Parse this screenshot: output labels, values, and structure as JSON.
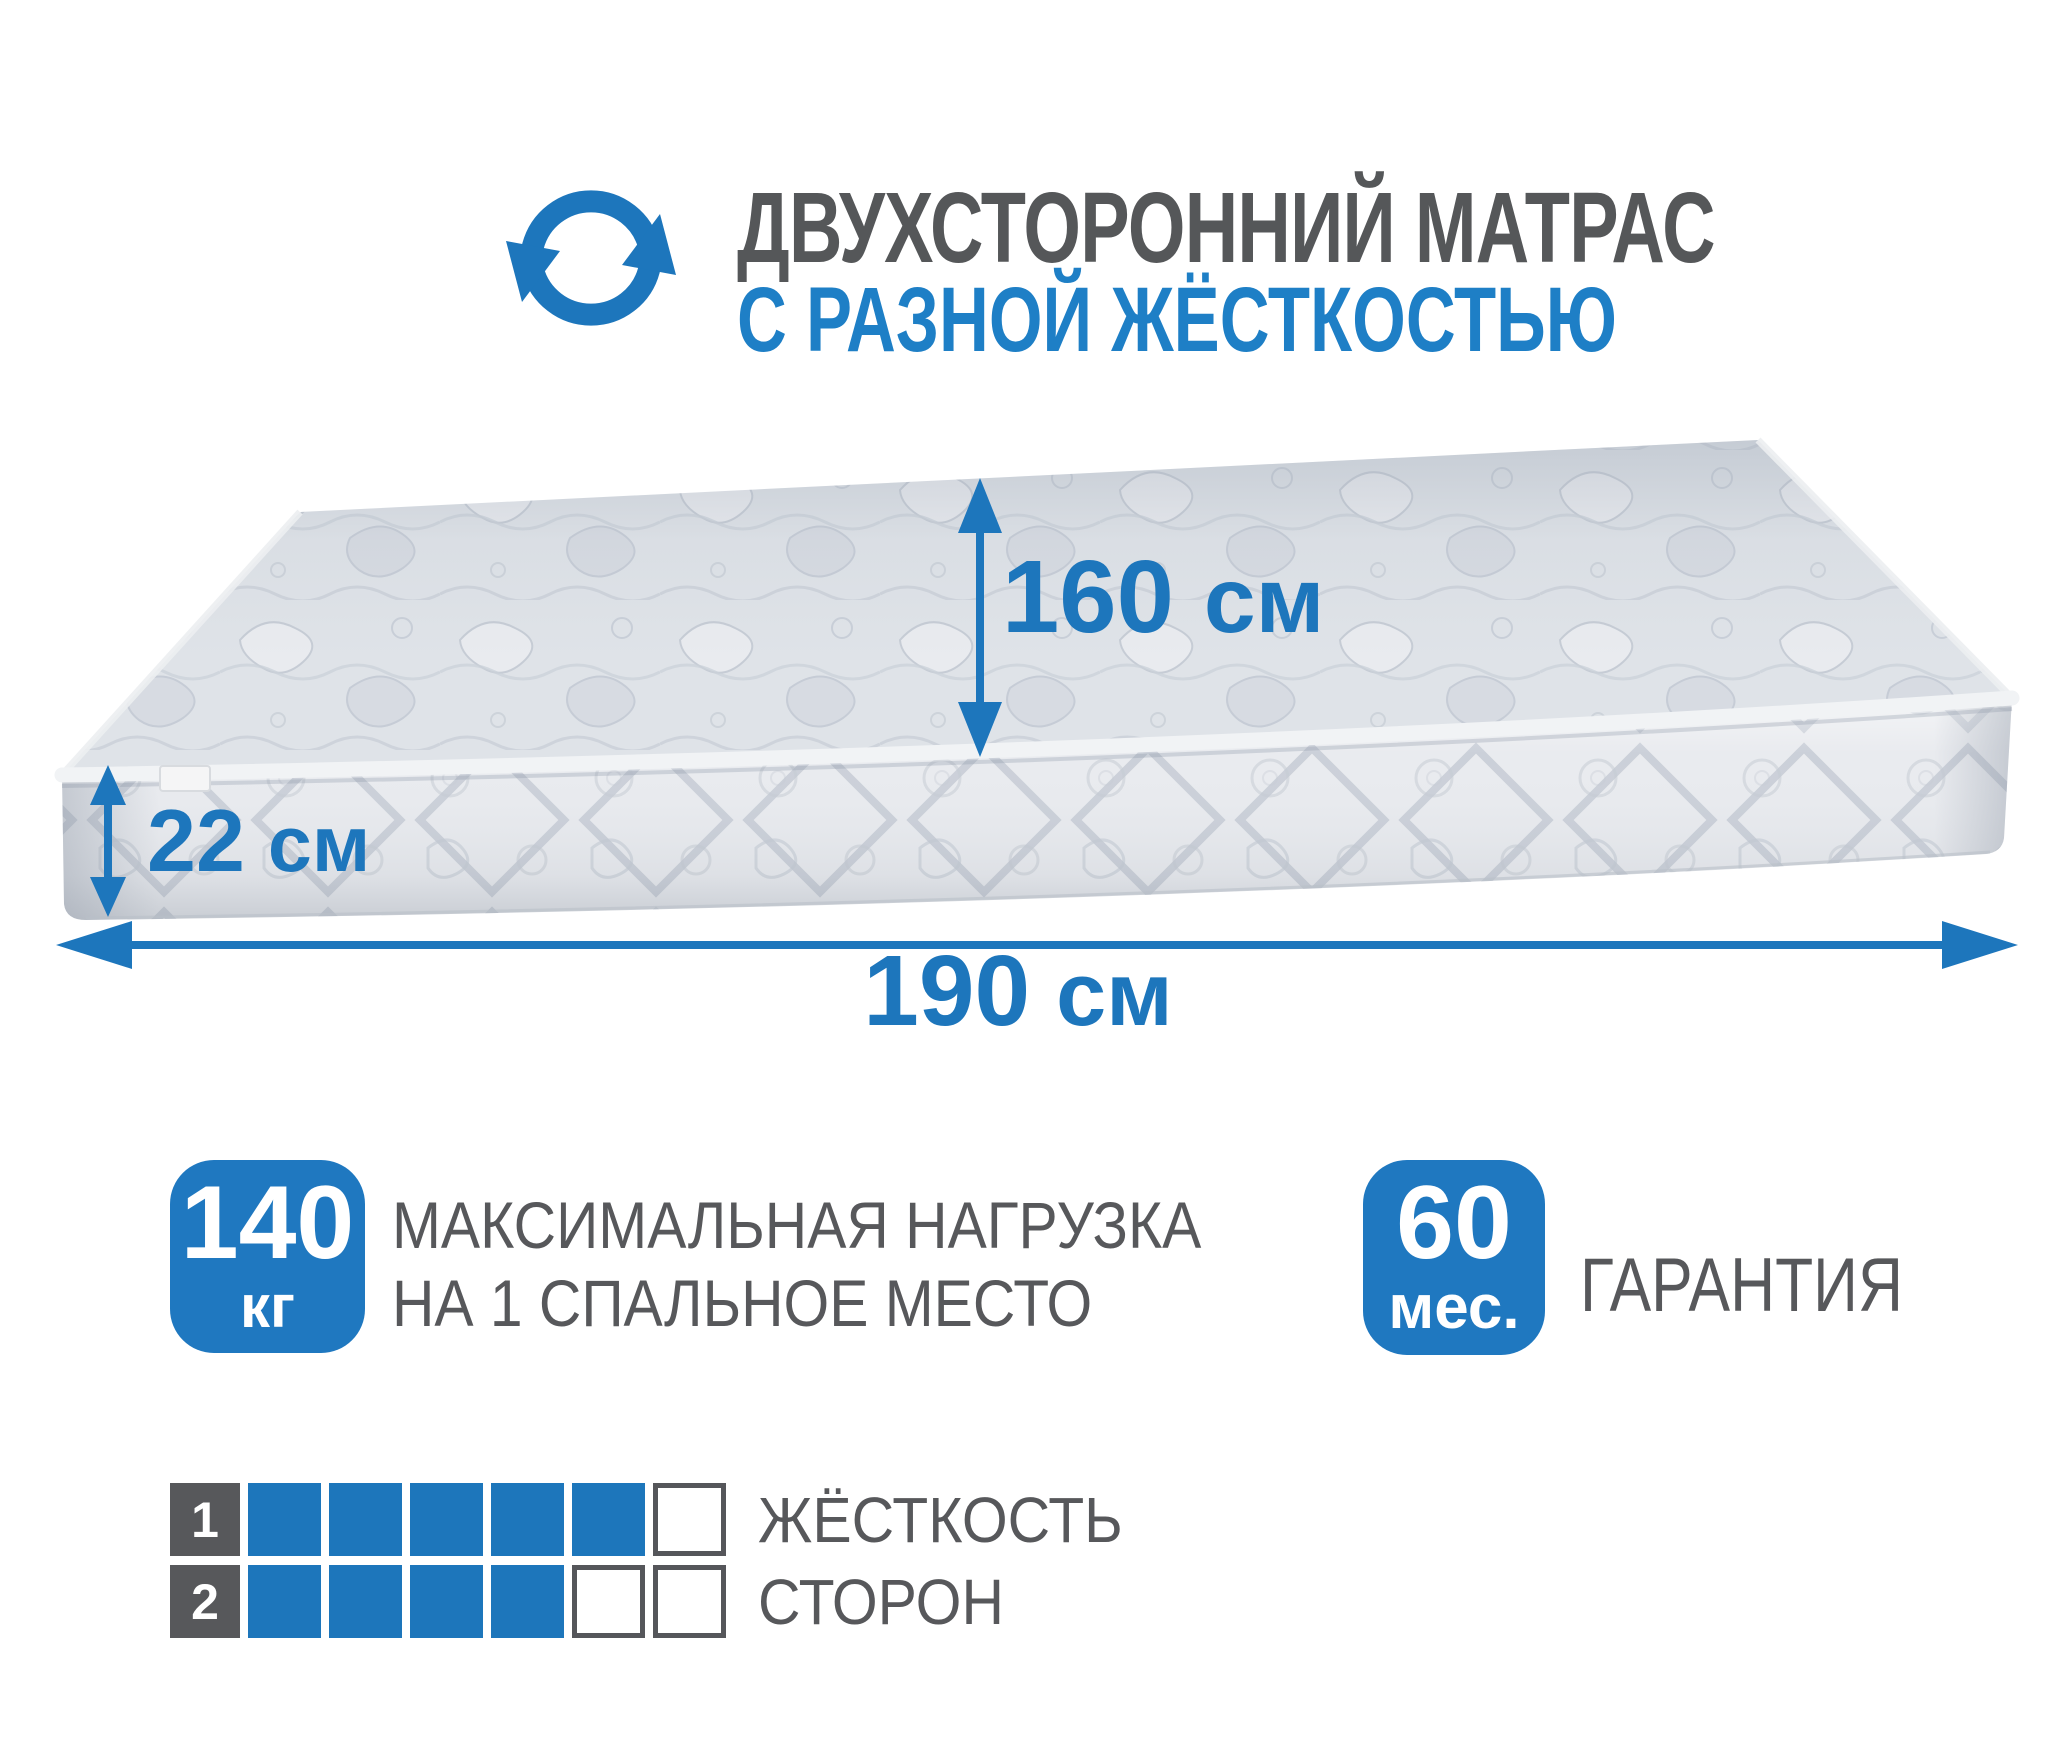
{
  "colors": {
    "accent": "#1d76bc",
    "gray_text": "#57585b"
  },
  "header": {
    "icon": "rotate-arrows-icon",
    "title": "ДВУХСТОРОННИЙ МАТРАС",
    "subtitle": "С РАЗНОЙ ЖЁСТКОСТЬЮ"
  },
  "dimensions": {
    "depth": {
      "value": "160",
      "unit": "см"
    },
    "height": {
      "value": "22",
      "unit": "см"
    },
    "length": {
      "value": "190",
      "unit": "см"
    }
  },
  "badges": {
    "max_load": {
      "value": "140",
      "unit": "кг",
      "label_line1": "МАКСИМАЛЬНАЯ НАГРУЗКА",
      "label_line2": "НА 1 СПАЛЬНОЕ МЕСТО"
    },
    "warranty": {
      "value": "60",
      "unit": "мес.",
      "label": "ГАРАНТИЯ"
    }
  },
  "firmness": {
    "label_line1": "ЖЁСТКОСТЬ",
    "label_line2": "СТОРОН",
    "scale_max": 6,
    "rows": [
      {
        "side": "1",
        "filled": 5
      },
      {
        "side": "2",
        "filled": 4
      }
    ]
  }
}
